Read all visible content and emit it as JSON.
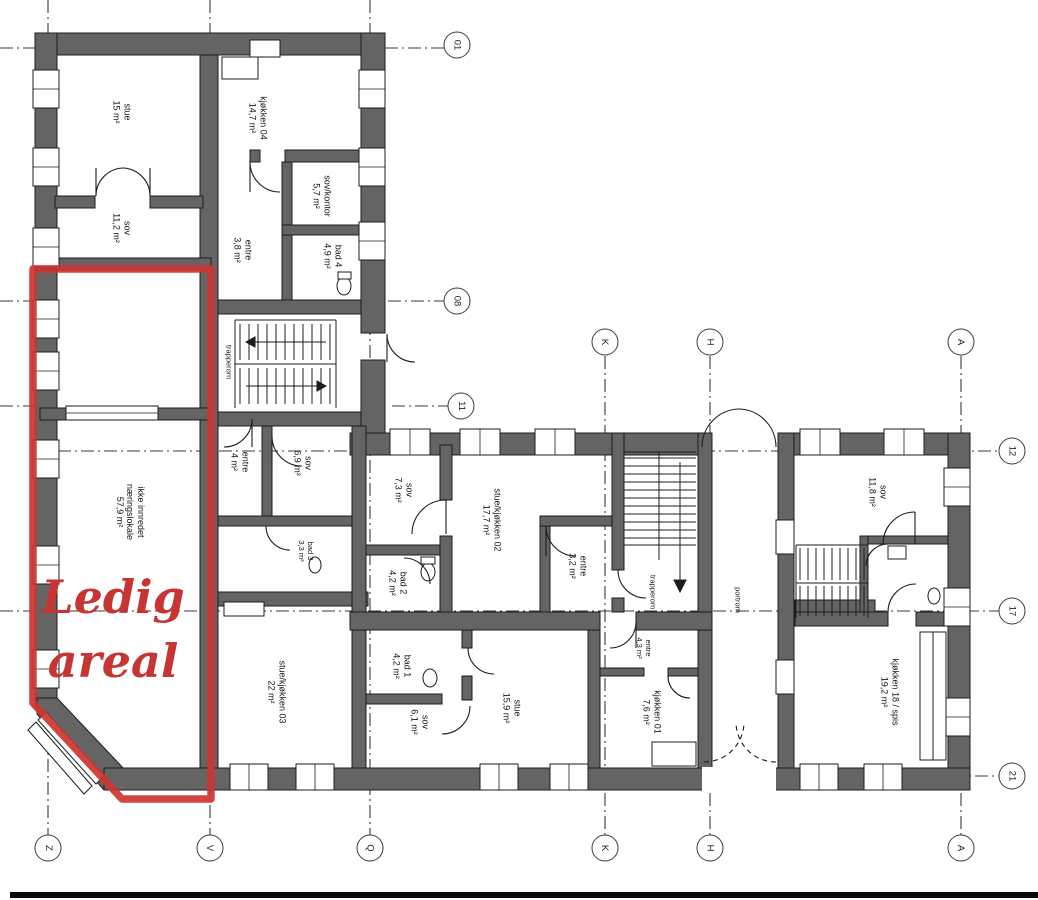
{
  "overlay": {
    "ledig_line1": "Ledig",
    "ledig_line2": "areal"
  },
  "rooms": [
    {
      "name": "stue-upper",
      "label": "stue\n15 m²"
    },
    {
      "name": "sov-upper",
      "label": "sov\n11,2 m²"
    },
    {
      "name": "kjokken-04",
      "label": "kjøkken 04\n14,7 m²"
    },
    {
      "name": "sov-kontor",
      "label": "sov/kontor\n5,7 m²"
    },
    {
      "name": "entre-upper",
      "label": "entre\n3,8 m²"
    },
    {
      "name": "bad-4",
      "label": "bad 4\n4,9 m²"
    },
    {
      "name": "trapperom-upper",
      "label": "trapperom"
    },
    {
      "name": "naeringslokale",
      "label": "ikke innredet\nnæringslokale\n57,9 m²"
    },
    {
      "name": "entre-mid",
      "label": "entre\n4 m²"
    },
    {
      "name": "sov-69",
      "label": "sov\n6,9 m²"
    },
    {
      "name": "bad-3",
      "label": "bad 3\n3,3 m²"
    },
    {
      "name": "sov-73",
      "label": "sov\n7,3 m²"
    },
    {
      "name": "bad-2",
      "label": "bad 2\n4,2 m²"
    },
    {
      "name": "stue-kjokken-02",
      "label": "stue/kjøkken 02\n17,7 m²"
    },
    {
      "name": "entre-32",
      "label": "entre\n3,2 m²"
    },
    {
      "name": "trapperom-mid",
      "label": "trapperom"
    },
    {
      "name": "portrom",
      "label": "portrom"
    },
    {
      "name": "sov-118",
      "label": "sov\n11,8 m²"
    },
    {
      "name": "stue-kjokken-03",
      "label": "stue/kjøkken 03\n22 m²"
    },
    {
      "name": "bad-1",
      "label": "bad 1\n4,2 m²"
    },
    {
      "name": "sov-61",
      "label": "sov\n6,1 m²"
    },
    {
      "name": "stue-159",
      "label": "stue\n15,9 m²"
    },
    {
      "name": "entre-43",
      "label": "entre\n4,3 m²"
    },
    {
      "name": "kjokken-01",
      "label": "kjøkken 01\n7,6 m²"
    },
    {
      "name": "kjokken-18",
      "label": "kjøkken 18 / spis\n19,2 m²"
    }
  ],
  "grid": {
    "bubbles": [
      {
        "label": "01"
      },
      {
        "label": "08"
      },
      {
        "label": "11"
      },
      {
        "label": "12"
      },
      {
        "label": "17"
      },
      {
        "label": "21"
      },
      {
        "label": "K"
      },
      {
        "label": "H"
      },
      {
        "label": "A"
      },
      {
        "label": "Z"
      },
      {
        "label": "V"
      },
      {
        "label": "Q"
      },
      {
        "label": "K"
      },
      {
        "label": "H"
      },
      {
        "label": "A"
      }
    ]
  },
  "colors": {
    "wall": "#646464",
    "line": "#1c1c1c",
    "red_outline": "#cd3531",
    "red_text": "#c63434",
    "background": "#ffffff"
  }
}
